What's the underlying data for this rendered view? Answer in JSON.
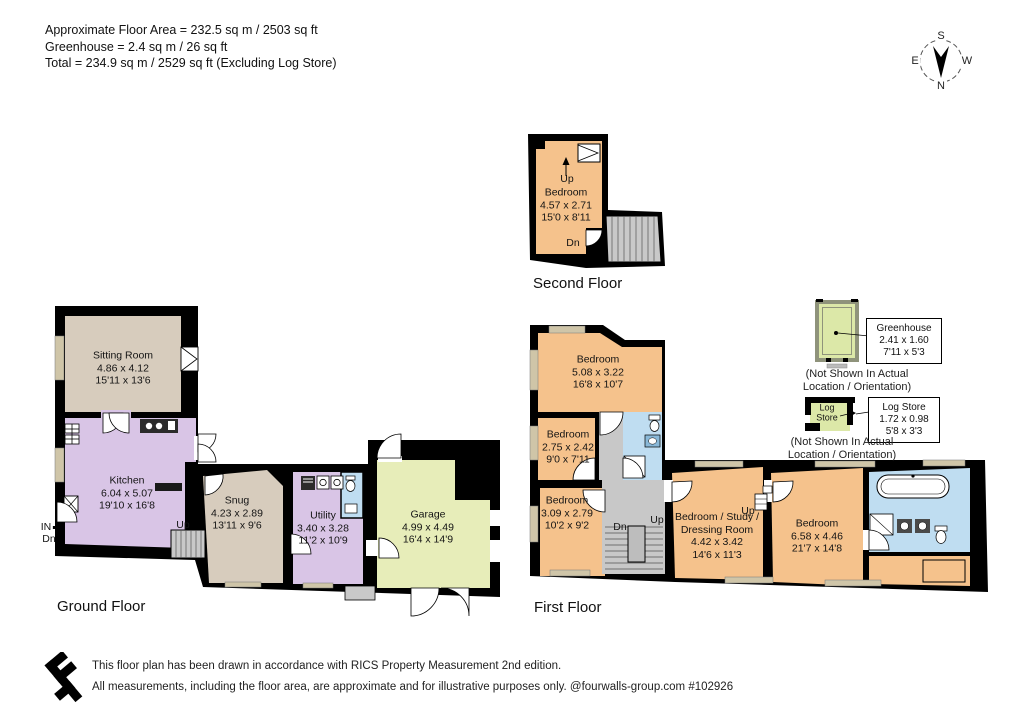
{
  "header": {
    "area_lines": [
      "Approximate Floor Area = 232.5 sq m / 2503 sq ft",
      "Greenhouse = 2.4 sq m / 26 sq ft",
      "Total = 234.9 sq m / 2529 sq ft (Excluding Log Store)"
    ]
  },
  "compass": {
    "north": "N",
    "south": "S",
    "east": "E",
    "west": "W"
  },
  "floors": {
    "second": {
      "title": "Second Floor",
      "rooms": [
        {
          "name": "Bedroom",
          "metric": "4.57 x 2.71",
          "imperial": "15'0 x 8'11"
        }
      ],
      "labels": {
        "up": "Up",
        "dn": "Dn"
      }
    },
    "ground": {
      "title": "Ground Floor",
      "rooms": [
        {
          "name": "Sitting Room",
          "metric": "4.86 x 4.12",
          "imperial": "15'11 x 13'6"
        },
        {
          "name": "Kitchen",
          "metric": "6.04 x 5.07",
          "imperial": "19'10 x 16'8"
        },
        {
          "name": "Snug",
          "metric": "4.23 x 2.89",
          "imperial": "13'11 x 9'6"
        },
        {
          "name": "Utility",
          "metric": "3.40 x 3.28",
          "imperial": "11'2 x 10'9"
        },
        {
          "name": "Garage",
          "metric": "4.99 x 4.49",
          "imperial": "16'4 x 14'9"
        }
      ],
      "labels": {
        "up": "Up",
        "in": "IN",
        "dn": "Dn"
      }
    },
    "first": {
      "title": "First Floor",
      "rooms": [
        {
          "name": "Bedroom",
          "metric": "5.08 x 3.22",
          "imperial": "16'8 x 10'7"
        },
        {
          "name": "Bedroom",
          "metric": "2.75 x 2.42",
          "imperial": "9'0 x 7'11"
        },
        {
          "name": "Bedroom",
          "metric": "3.09 x 2.79",
          "imperial": "10'2 x 9'2"
        },
        {
          "name": "Bedroom / Study / Dressing Room",
          "metric": "4.42 x 3.42",
          "imperial": "14'6 x 11'3"
        },
        {
          "name": "Bedroom",
          "metric": "6.58 x 4.46",
          "imperial": "21'7 x 14'8"
        }
      ],
      "labels": {
        "up": "Up",
        "dn": "Dn"
      }
    }
  },
  "outbuildings": {
    "greenhouse": {
      "name": "Greenhouse",
      "metric": "2.41 x 1.60",
      "imperial": "7'11 x 5'3",
      "note_line1": "(Not Shown In Actual",
      "note_line2": "Location / Orientation)"
    },
    "log_store": {
      "name": "Log Store",
      "metric": "1.72 x 0.98",
      "imperial": "5'8 x 3'3",
      "interior_label_line1": "Log",
      "interior_label_line2": "Store",
      "note_line1": "(Not Shown In Actual",
      "note_line2": "Location / Orientation)"
    }
  },
  "footer": {
    "line1": "This floor plan has been drawn in accordance with RICS Property Measurement 2nd edition.",
    "line2": "All measurements, including the floor area, are approximate and for illustrative purposes only. @fourwalls-group.com #102926"
  },
  "colors": {
    "wall": "#000000",
    "bedroom_orange": "#f5c28c",
    "kitchen_lavender": "#d9c5e6",
    "sitting_taupe": "#d7ccbd",
    "garage_green": "#e7edb9",
    "bathroom_blue": "#bfddf1",
    "stairs_gray": "#c8c8c8",
    "window_tan": "#cfc5a8",
    "greenhouse_wall": "#8f937b",
    "greenhouse_fill": "#dce8a8"
  }
}
